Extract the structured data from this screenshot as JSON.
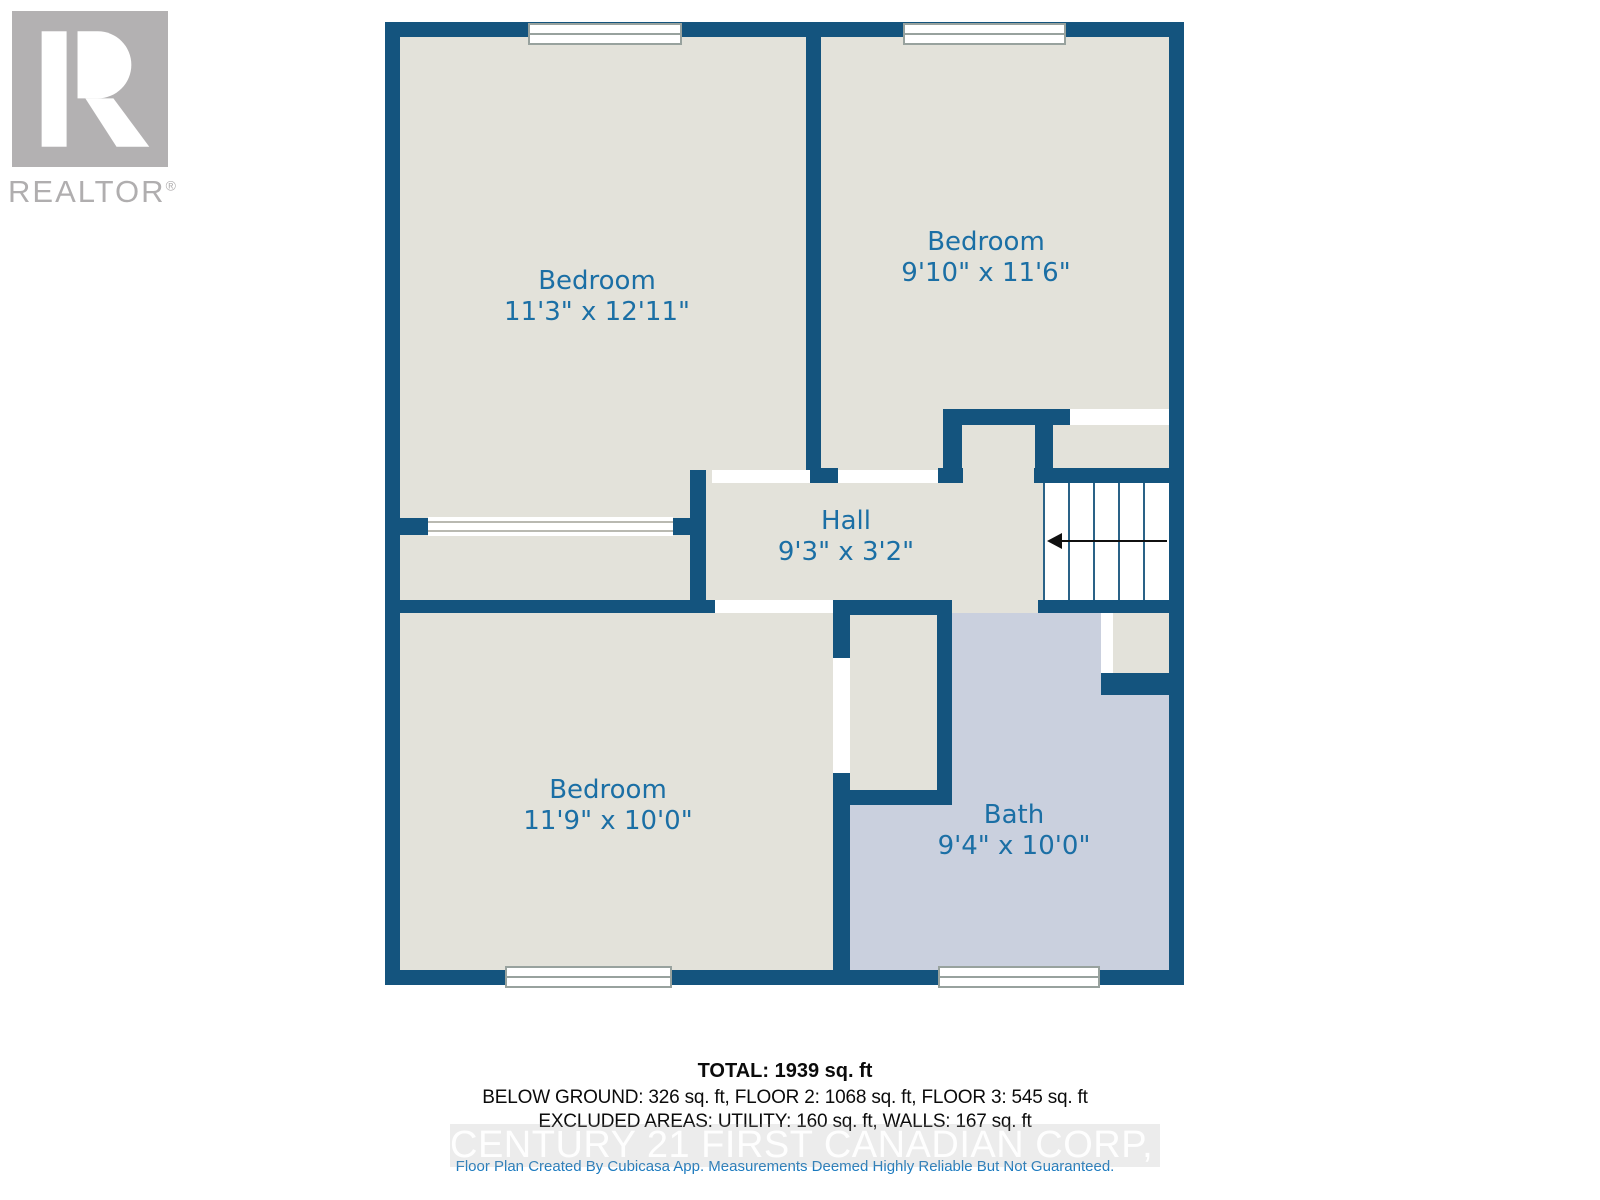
{
  "branding": {
    "name": "REALTOR",
    "reg": "®"
  },
  "rooms": {
    "bedroom_tl": {
      "name": "Bedroom",
      "dims": "11'3\" x 12'11\""
    },
    "bedroom_tr": {
      "name": "Bedroom",
      "dims": "9'10\" x 11'6\""
    },
    "hall": {
      "name": "Hall",
      "dims": "9'3\" x 3'2\""
    },
    "bedroom_bl": {
      "name": "Bedroom",
      "dims": "11'9\" x 10'0\""
    },
    "bath": {
      "name": "Bath",
      "dims": "9'4\" x 10'0\""
    }
  },
  "summary": {
    "total": "TOTAL: 1939 sq. ft",
    "floors": "BELOW GROUND: 326 sq. ft, FLOOR 2: 1068 sq. ft, FLOOR 3: 545 sq. ft",
    "excluded": "EXCLUDED AREAS: UTILITY: 160 sq. ft, WALLS: 167 sq. ft"
  },
  "watermark": "CENTURY 21 FIRST CANADIAN CORP, Brokerage",
  "disclaimer": "Floor Plan Created By Cubicasa App. Measurements Deemed Highly Reliable But Not Guaranteed.",
  "colors": {
    "wall": "#14547e",
    "floor": "#e3e2da",
    "bath_floor": "#cad0de",
    "room_label": "#1b6fa5",
    "logo_gray": "#b3b1b2",
    "disclaimer_blue": "#1a79be",
    "watermark_gray": "#d6d6d6"
  }
}
